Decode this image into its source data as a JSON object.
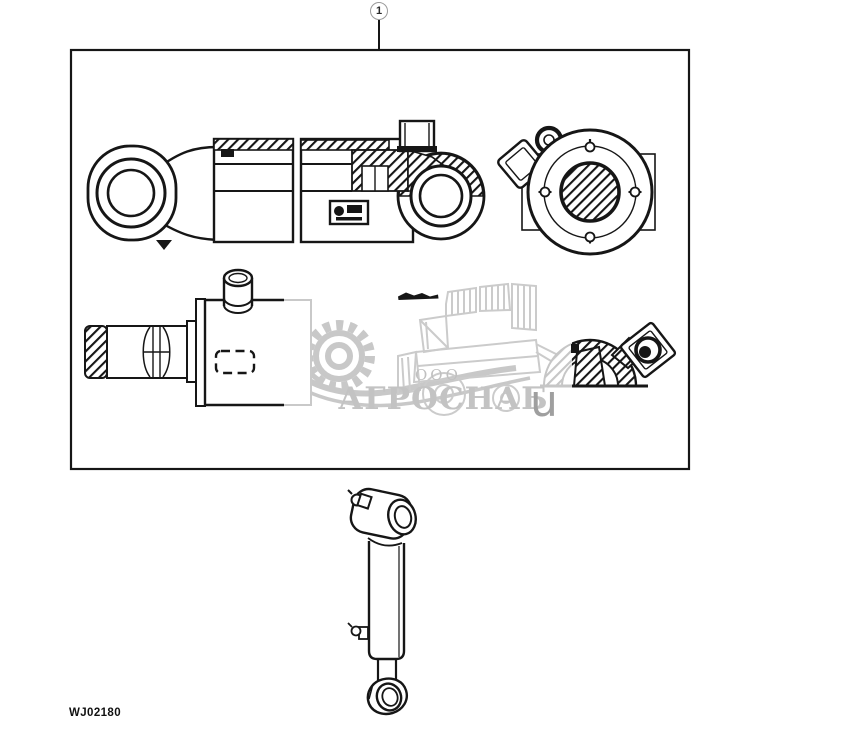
{
  "page": {
    "background": "#ffffff",
    "line_color": "#161616"
  },
  "callout": {
    "number": "1"
  },
  "watermark": {
    "org_prefix": "ООО",
    "org_name": "АГРОСНАБ",
    "stray_char": "u",
    "color": "#c6c6c6"
  },
  "footer": {
    "drawing_code": "WJ02180"
  }
}
